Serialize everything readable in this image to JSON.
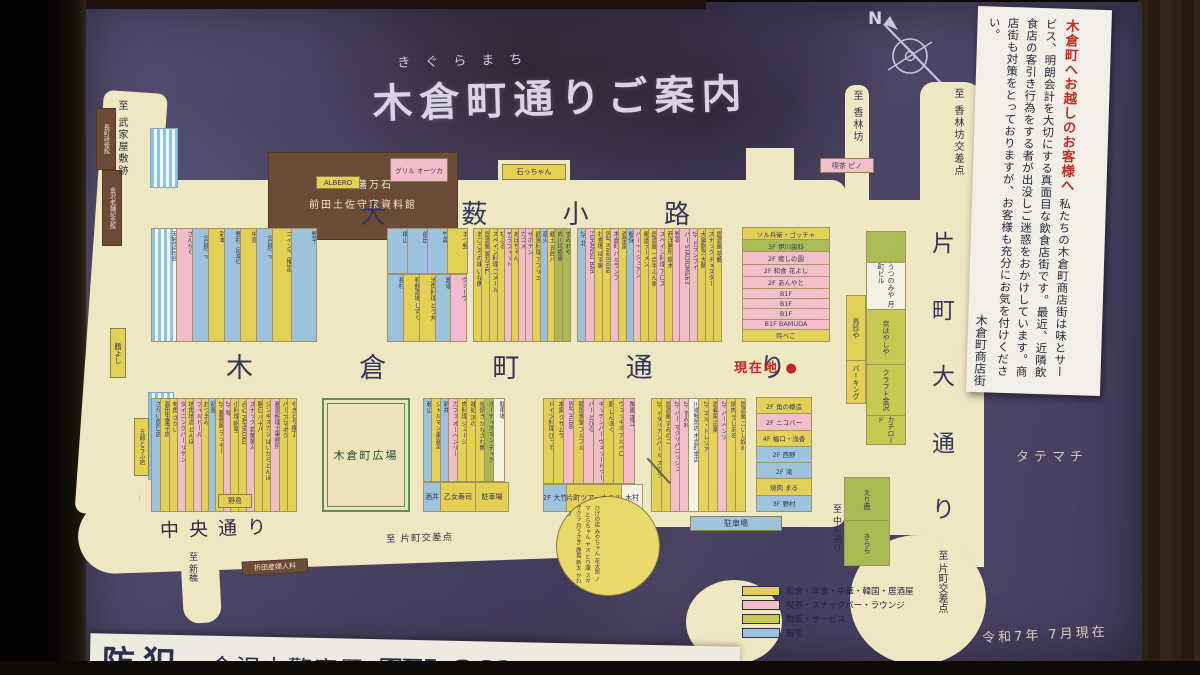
{
  "title": {
    "furigana": "きぐらまち",
    "text": "木倉町通りご案内"
  },
  "compass": {
    "label": "N"
  },
  "notice": {
    "title": "木倉町へお越しのお客様へ",
    "body": "私たちの木倉町商店街は味とサービス、明朗会計を大切にする真面目な飲食店街です。最近、近隣飲食店の客引き行為をする者が出没しご迷惑をおかけしています。商店街も対策をとっておりますが、お客様も充分にお気を付けください。",
    "signature": "木倉町商店街"
  },
  "streets": {
    "oyabu": "大薮小路",
    "kigura": "木倉町通り",
    "katamachi": "片町大通り",
    "chuo": "中央通り"
  },
  "directions": {
    "buke": "至 武家屋敷跡",
    "korinbo": "至 香林坊",
    "korinbo_x": "至 香林坊交差点",
    "chuo_s": "至 中央通り",
    "katamachi_x": "至 片町交差点",
    "katamachi_x2": "至 片町交差点",
    "shinbashi": "至 新橋",
    "tatemachi": "タテマチ"
  },
  "markers": {
    "current": "現在地",
    "dot": "●",
    "date": "令和7年 7月現在"
  },
  "landmarks": {
    "museum_line1": "加賀藩万石",
    "museum_line2": "前田土佐守家資料館",
    "nagamachi": "長町研修館",
    "shinise": "金沢老舗記念館",
    "plaza": "木倉町広場"
  },
  "tags": {
    "albero": "ALBERO",
    "grill": "グリル オーツカ",
    "ishi": "石っちゃん",
    "pino": "喫茶 ピノ",
    "tsuruyoshi": "鶴よし",
    "gorotofu": "五郎とうふ店",
    "nojima": "野島",
    "orita": "折田産婦人科",
    "parking_sd": "駐車場"
  },
  "police": {
    "bouhan": "防犯",
    "station": "金沢中警察署",
    "tel": "TEL 262-1171",
    "partial": "香林坊"
  },
  "legend": {
    "items": [
      {
        "c": "y",
        "label": "和食・洋食・中華・韓国・居酒屋"
      },
      {
        "c": "p",
        "label": "喫茶・スナックバー・ラウンジ"
      },
      {
        "c": "yg",
        "label": "物販・サービス"
      },
      {
        "c": "b",
        "label": "居宅"
      }
    ]
  },
  "blocks": {
    "n_a": {
      "strips": [
        {
          "t": "天野区民会",
          "c": "st",
          "w": 26
        },
        {
          "t": "さんかく",
          "c": "p",
          "w": 17
        },
        {
          "t": "（月極）P",
          "c": "b",
          "w": 17
        },
        {
          "t": "彩本",
          "c": "y",
          "w": 17
        },
        {
          "t": "野村（BMS）",
          "c": "b",
          "w": 17
        },
        {
          "t": "中見",
          "c": "y",
          "w": 17
        },
        {
          "t": "（月極）P",
          "c": "b",
          "w": 17
        },
        {
          "t": "コインP（推定）",
          "c": "y",
          "w": 20
        },
        {
          "t": "野平",
          "c": "b",
          "w": 26
        }
      ]
    },
    "n_b_top": [
      {
        "t": "横山",
        "c": "b",
        "w": 21
      },
      {
        "t": "前田",
        "c": "b",
        "w": 21
      },
      {
        "t": "竹森",
        "c": "b",
        "w": 21
      },
      {
        "t": "まつ野",
        "c": "y",
        "w": 21
      }
    ],
    "n_b_bottom": [
      {
        "t": "長村",
        "c": "b",
        "w": 17
      },
      {
        "t": "和飲酒場 しずく",
        "c": "y",
        "w": 17
      },
      {
        "t": "池魚料理 とう丸",
        "c": "y",
        "w": 17
      },
      {
        "t": "雲端",
        "c": "b",
        "w": 16
      },
      {
        "t": "ヴァーヴ",
        "c": "p",
        "w": 17
      }
    ],
    "n_c": {
      "strips": [
        {
          "t": "まごころの味 いな穂",
          "c": "y",
          "w": 9
        },
        {
          "t": "居酒屋 源左エ門",
          "c": "y",
          "w": 9
        },
        {
          "t": "スペイン料理 コメール",
          "c": "y",
          "w": 9
        },
        {
          "t": "もふる",
          "c": "y",
          "w": 8
        },
        {
          "t": "テラフィット",
          "c": "p",
          "w": 8
        },
        {
          "t": "あばちゃん",
          "c": "y",
          "w": 8
        },
        {
          "t": "カゴメ",
          "c": "p",
          "w": 8
        },
        {
          "t": "サボテン",
          "c": "p",
          "w": 8
        },
        {
          "t": "欧風料理 アプリエ",
          "c": "y",
          "w": 9
        },
        {
          "t": "高火",
          "c": "b",
          "w": 8
        },
        {
          "t": "郷土 五郎八",
          "c": "y",
          "w": 8
        },
        {
          "t": "向川玲樹園",
          "c": "g",
          "w": 9
        },
        {
          "t": "すみれや",
          "c": "g",
          "w": 9
        }
      ]
    },
    "n_e": {
      "strips": [
        {
          "t": "2F 北",
          "c": "b",
          "w": 9
        },
        {
          "t": "FURANSU BAR",
          "c": "p",
          "w": 10
        },
        {
          "t": "わ食場 はす家",
          "c": "y",
          "w": 9
        },
        {
          "t": "Bar RivedToile",
          "c": "y",
          "w": 9
        },
        {
          "t": "木倉町 バルランプ",
          "c": "p",
          "w": 9
        },
        {
          "t": "酒菜家",
          "c": "y",
          "w": 9
        },
        {
          "t": "飯保",
          "c": "b",
          "w": 8
        },
        {
          "t": "バー F・ジョアン",
          "c": "p",
          "w": 8
        },
        {
          "t": "尾道ラーメン",
          "c": "y",
          "w": 9
        },
        {
          "t": "居酒屋 一合半ぶん家",
          "c": "y",
          "w": 9
        },
        {
          "t": "スペイン料理 アロス",
          "c": "p",
          "w": 9
        },
        {
          "t": "西洋勝所 鍋木",
          "c": "y",
          "w": 9
        },
        {
          "t": "野亭",
          "c": "p",
          "w": 8
        },
        {
          "t": "バー STADIUM&63",
          "c": "p",
          "w": 11
        },
        {
          "t": "2F ドランブイ",
          "c": "p",
          "w": 9
        },
        {
          "t": "大衆割烹 大関",
          "c": "y",
          "w": 9
        },
        {
          "t": "スナック チェスター",
          "c": "y",
          "w": 9
        },
        {
          "t": "居酒屋 花鯛",
          "c": "y",
          "w": 9
        }
      ]
    },
    "n_g": {
      "rows": [
        {
          "t": "ソル兵衛・ゴッチャ",
          "c": "y"
        },
        {
          "t": "3F 伊川歯科",
          "c": "g"
        },
        {
          "t": "2F 癒しの園",
          "c": "p"
        },
        {
          "t": "2F 和食 花よし",
          "c": "p"
        },
        {
          "t": "2F あんやと",
          "c": "p"
        },
        {
          "t": "B1F",
          "c": "p"
        },
        {
          "t": "B1F",
          "c": "p"
        },
        {
          "t": "B1F",
          "c": "p"
        },
        {
          "t": "B1F BAMUDA",
          "c": "p"
        },
        {
          "t": "吟べこ",
          "c": "y"
        }
      ]
    },
    "s_a": {
      "strips": [
        {
          "t": "さかい辰巳店",
          "c": "b",
          "w": 10
        },
        {
          "t": "高田生菓子店",
          "c": "y",
          "w": 10
        },
        {
          "t": "旬魚 さかい",
          "c": "y",
          "w": 9
        },
        {
          "t": "ダイニングバー リケン",
          "c": "p",
          "w": 9
        },
        {
          "t": "地魚地酒 とんぼ",
          "c": "y",
          "w": 9
        },
        {
          "t": "フィルドール",
          "c": "p",
          "w": 9
        },
        {
          "t": "おつまみ",
          "c": "y",
          "w": 8
        },
        {
          "t": "初風",
          "c": "b",
          "w": 8
        },
        {
          "t": "2F 薔薇屋 ラッキー",
          "c": "y",
          "w": 9
        },
        {
          "t": "2F 琴",
          "c": "p",
          "w": 8
        },
        {
          "t": "小料理 帆星",
          "c": "y",
          "w": 9
        },
        {
          "t": "点心 PAPIROKU",
          "c": "y",
          "w": 9
        },
        {
          "t": "スナック 若葉美人",
          "c": "p",
          "w": 9
        },
        {
          "t": "朝日 八十八",
          "c": "y",
          "w": 9
        },
        {
          "t": "ジンギスカン はいからとんぼ",
          "c": "y",
          "w": 9
        },
        {
          "t": "嘉島税理士事務所",
          "c": "p",
          "w": 10
        },
        {
          "t": "バー アマネク",
          "c": "y",
          "w": 9
        },
        {
          "t": "やきとり横丁",
          "c": "y",
          "w": 10
        }
      ]
    },
    "s_b_main": [
      {
        "t": "乾山",
        "c": "b",
        "w": 9
      },
      {
        "t": "シャルマン美容室",
        "c": "y",
        "w": 10
      },
      {
        "t": "新井",
        "c": "b",
        "w": 9
      },
      {
        "t": "カフェ オーヘンリー",
        "c": "p",
        "w": 10
      },
      {
        "t": "肉料理 ジョージ",
        "c": "y",
        "w": 10
      },
      {
        "t": "味処 浜の",
        "c": "y",
        "w": 10
      },
      {
        "t": "炭焼き かなざわ鴨",
        "c": "y",
        "w": 10
      },
      {
        "t": "オーディオマン ディグ",
        "c": "g",
        "w": 10
      },
      {
        "t": "駐車場",
        "c": "w",
        "w": 12
      }
    ],
    "s_b_bottom": [
      {
        "t": "酒井",
        "c": "b",
        "w": 18
      },
      {
        "t": "乙女寿司",
        "c": "y",
        "w": 36
      },
      {
        "t": "駐車場",
        "c": "y",
        "w": 34
      }
    ],
    "s_c_main": [
      {
        "t": "ドイツ料理 ぴって",
        "c": "y",
        "w": 11
      },
      {
        "t": "本家 クサムラ",
        "c": "y",
        "w": 11
      },
      {
        "t": "Bar Hubb",
        "c": "p",
        "w": 11
      },
      {
        "t": "韓国食堂 プルプル",
        "c": "y",
        "w": 11
      },
      {
        "t": "バー とびら",
        "c": "p",
        "w": 11
      },
      {
        "t": "キッチンバー ヴェッードゥー",
        "c": "p",
        "w": 11
      },
      {
        "t": "廚 しんきく",
        "c": "y",
        "w": 11
      },
      {
        "t": "ヴェッキオ アルベロ",
        "c": "y",
        "w": 11
      },
      {
        "t": "陶園 逢江",
        "c": "p",
        "w": 12
      }
    ],
    "s_c_bottom": [
      {
        "t": "2F 大竹",
        "c": "b",
        "w": 24
      },
      {
        "t": "片町ツアーホテル",
        "c": "y",
        "w": 56
      },
      {
        "t": "木村",
        "c": "w",
        "w": 22
      }
    ],
    "s_d": {
      "strips": [
        {
          "t": "2F イタリアンバール スカラ",
          "c": "y",
          "w": 11
        },
        {
          "t": "居酒屋 すみのこ",
          "c": "y",
          "w": 10
        },
        {
          "t": "2F バー マクリバニッシュ",
          "c": "p",
          "w": 10
        },
        {
          "t": "2F すみれ",
          "c": "p",
          "w": 10
        },
        {
          "t": "川端鮮魚店 木倉町本店",
          "c": "w",
          "w": 11
        },
        {
          "t": "2F エル・トレゾア",
          "c": "y",
          "w": 11
        },
        {
          "t": "酒肴家 逗楽",
          "c": "y",
          "w": 10
        },
        {
          "t": "2F バーベンツ",
          "c": "p",
          "w": 10
        },
        {
          "t": "焼肉 うしまる",
          "c": "y",
          "w": 10
        },
        {
          "t": "居酒屋 ごいし奴Ⅱ",
          "c": "y",
          "w": 11
        }
      ]
    },
    "s_d_rows": [
      {
        "t": "2F 角の樽造",
        "c": "y"
      },
      {
        "t": "2F ニコバー",
        "c": "p"
      },
      {
        "t": "4F 幅口・浅香",
        "c": "y"
      },
      {
        "t": "2F 西野",
        "c": "b"
      },
      {
        "t": "2F 滝",
        "c": "b"
      },
      {
        "t": "焼肉 まる",
        "c": "y"
      },
      {
        "t": "3F 野村",
        "c": "b"
      }
    ],
    "right_a": [
      {
        "t": "鳥珍や",
        "c": "y",
        "h": 66
      },
      {
        "t": "パーキング",
        "c": "y",
        "h": 44
      }
    ],
    "right_b": [
      {
        "t": "",
        "c": "g",
        "h": 32
      },
      {
        "t": "うつのみや 月町ビル",
        "c": "w",
        "h": 48
      },
      {
        "t": "京はやしや",
        "c": "yg",
        "h": 56
      },
      {
        "t": "クラフト金沢",
        "c": "yg",
        "h": 52
      },
      {
        "t": "カチロード",
        "c": "yg",
        "h": 30
      }
    ],
    "right_c": [
      {
        "t": "えり鹿",
        "c": "g",
        "h": 44
      },
      {
        "t": "きらら",
        "c": "g",
        "h": 46
      }
    ]
  },
  "bubble": {
    "names": "ひげの店 みやちゃん 花太郎 ノマ とらちゃん ヤス とり康 スギ ザクラ 月うさぎ 鹿島 新太 かわっき"
  }
}
